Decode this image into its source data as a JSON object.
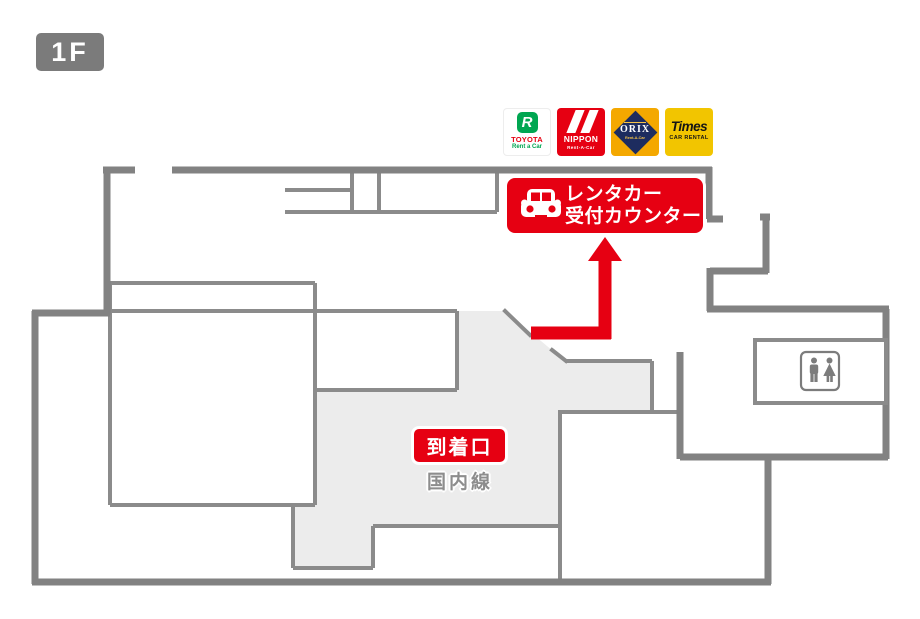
{
  "floor_badge": "1F",
  "logos": {
    "toyota": {
      "mark": "R",
      "brand": "TOYOTA",
      "sub": "Rent a Car"
    },
    "nippon": {
      "brand": "NIPPON",
      "sub": "Rent-A-Car"
    },
    "orix": {
      "brand": "ORIX",
      "sub": "Rent-A-Car"
    },
    "times": {
      "brand": "Times",
      "sub": "CAR RENTAL"
    }
  },
  "counter_banner": {
    "line1": "レンタカー",
    "line2": "受付カウンター"
  },
  "labels": {
    "arrival_gate": "到着口",
    "domestic_line": "国内線"
  },
  "colors": {
    "accent_red": "#e60012",
    "wall_gray": "#828282",
    "floor_fill": "#ececec",
    "badge_gray": "#7b7b7b",
    "toyota_green": "#00a651",
    "orix_amber": "#f4a800",
    "orix_navy": "#1d2c5f",
    "times_yellow": "#f2c500"
  }
}
